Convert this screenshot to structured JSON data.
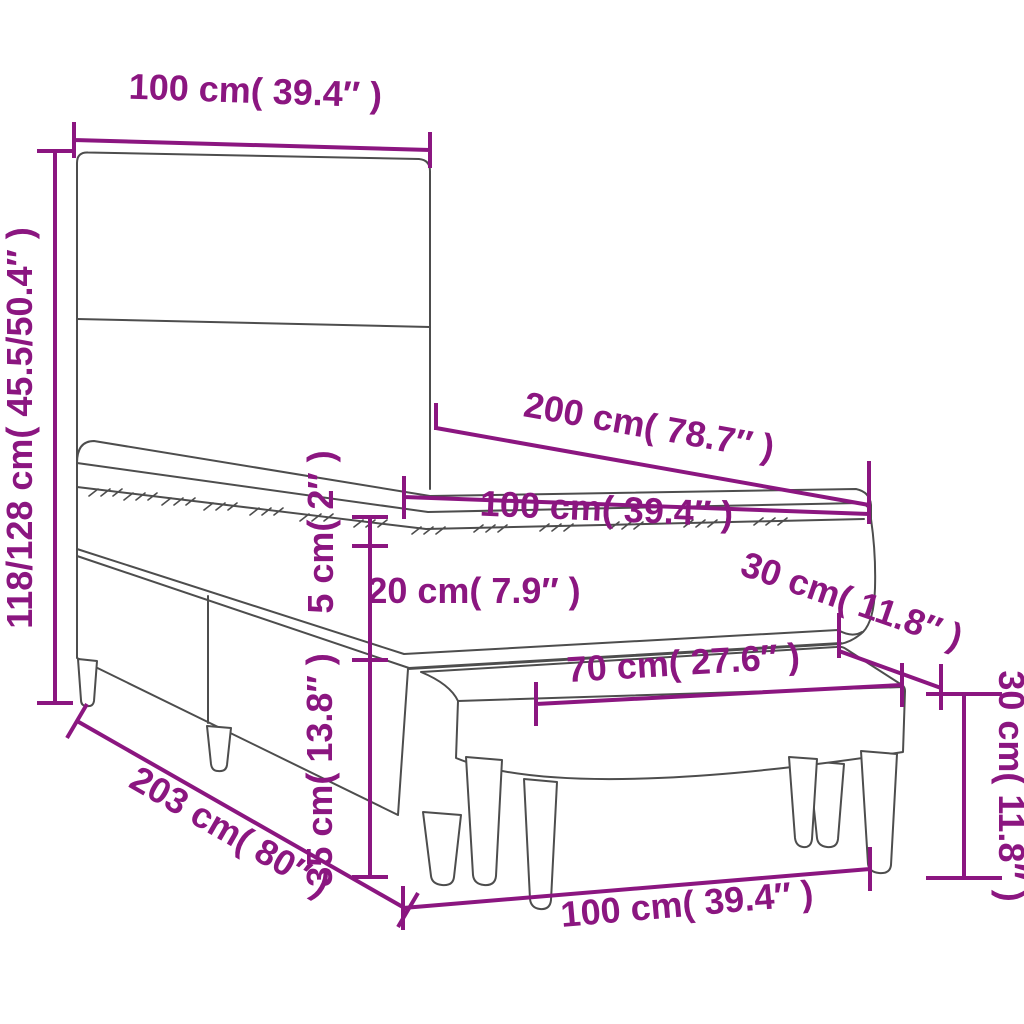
{
  "colors": {
    "accent": "#8B1680",
    "line": "#4d4d4d",
    "background": "#ffffff"
  },
  "dimensions": {
    "headboard_width": "100 cm( 39.4″ )",
    "total_height": "118/128 cm( 45.5/50.4″ )",
    "mattress_length": "200 cm( 78.7″ )",
    "mattress_width": "100 cm( 39.4″ )",
    "topper_height": "5 cm( 2″ )",
    "mattress_height": "20 cm( 7.9″ )",
    "base_height": "35 cm( 13.8″ )",
    "bed_length": "203 cm( 80″ )",
    "bench_seat_width": "70 cm( 27.6″ )",
    "bench_depth": "30 cm( 11.8″ )",
    "bench_height": "30 cm( 11.8″ )",
    "bench_length": "100 cm( 39.4″ )"
  }
}
